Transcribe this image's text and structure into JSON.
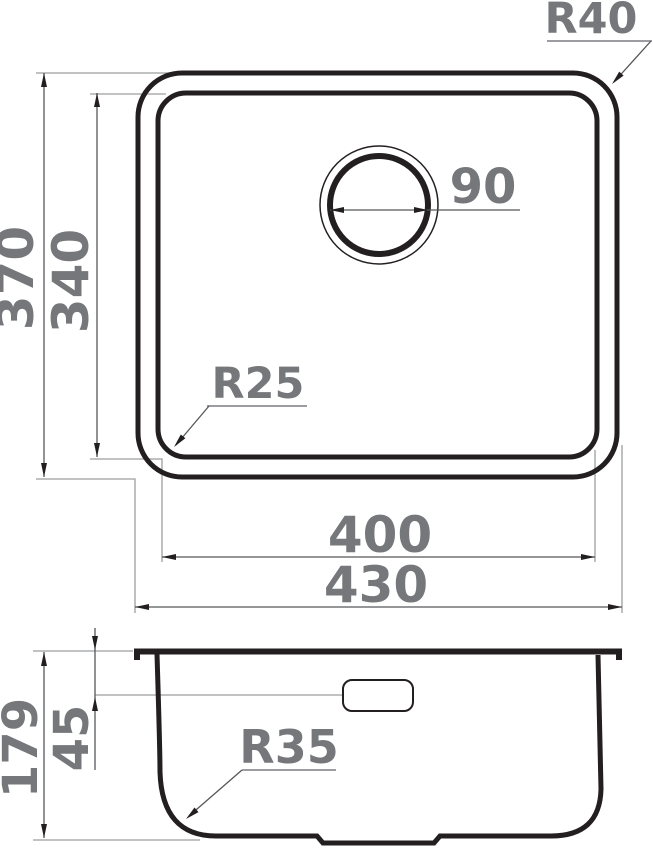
{
  "drawing": {
    "type": "technical-dimension-drawing",
    "subject": "undermount kitchen sink",
    "colors": {
      "outline": "#231f20",
      "dimension_line": "#55575b",
      "extension_line": "#9b9da0",
      "label": "#75777a",
      "background": "#ffffff"
    },
    "top_view": {
      "dims": {
        "outer_height": "370",
        "inner_height": "340",
        "drain_diameter": "90",
        "outer_corner_radius": "R40",
        "inner_corner_radius": "R25",
        "inner_width": "400",
        "outer_width": "430"
      }
    },
    "side_view": {
      "dims": {
        "total_depth": "179",
        "overflow_depth": "45",
        "bottom_corner_radius": "R35"
      }
    }
  }
}
